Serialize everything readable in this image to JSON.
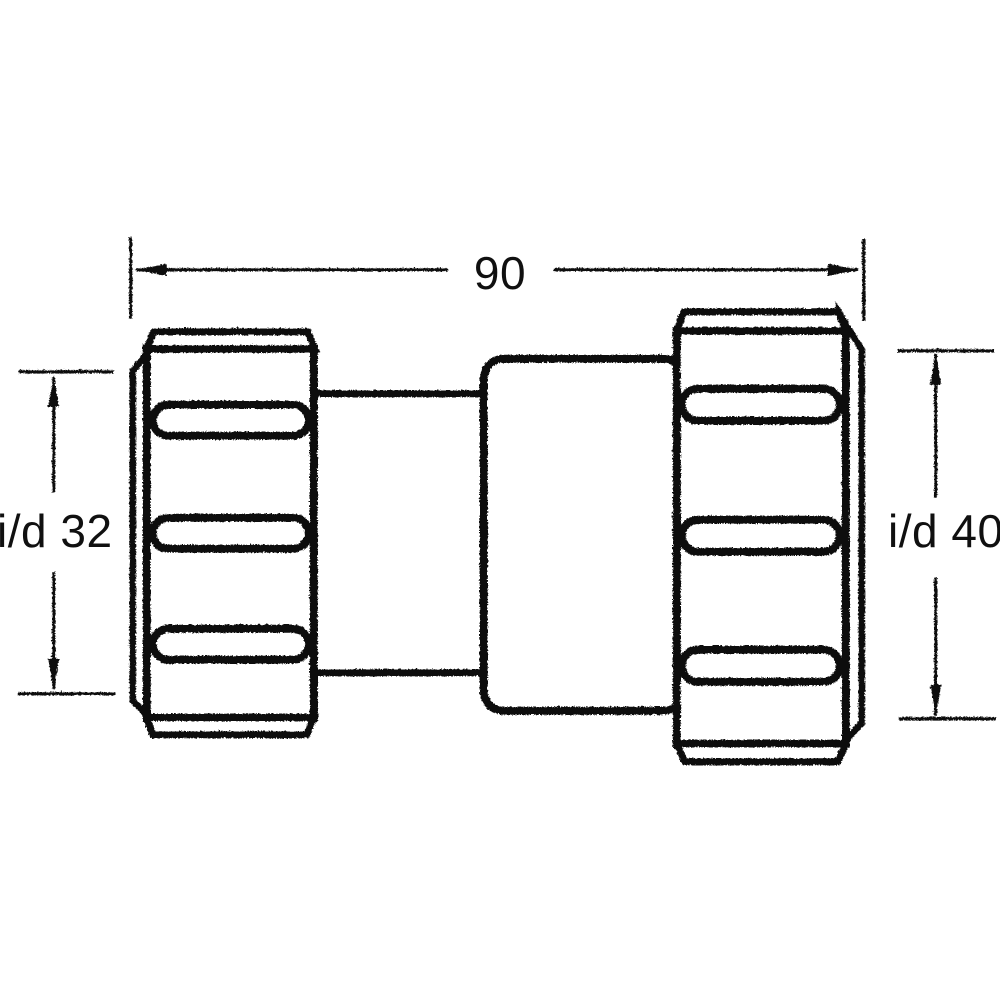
{
  "document": {
    "background_color": "#ffffff",
    "ink_color": "#101010"
  },
  "labels": {
    "overall_length": "90",
    "left_inner_diameter": "i/d 32",
    "right_inner_diameter": "i/d 40"
  }
}
